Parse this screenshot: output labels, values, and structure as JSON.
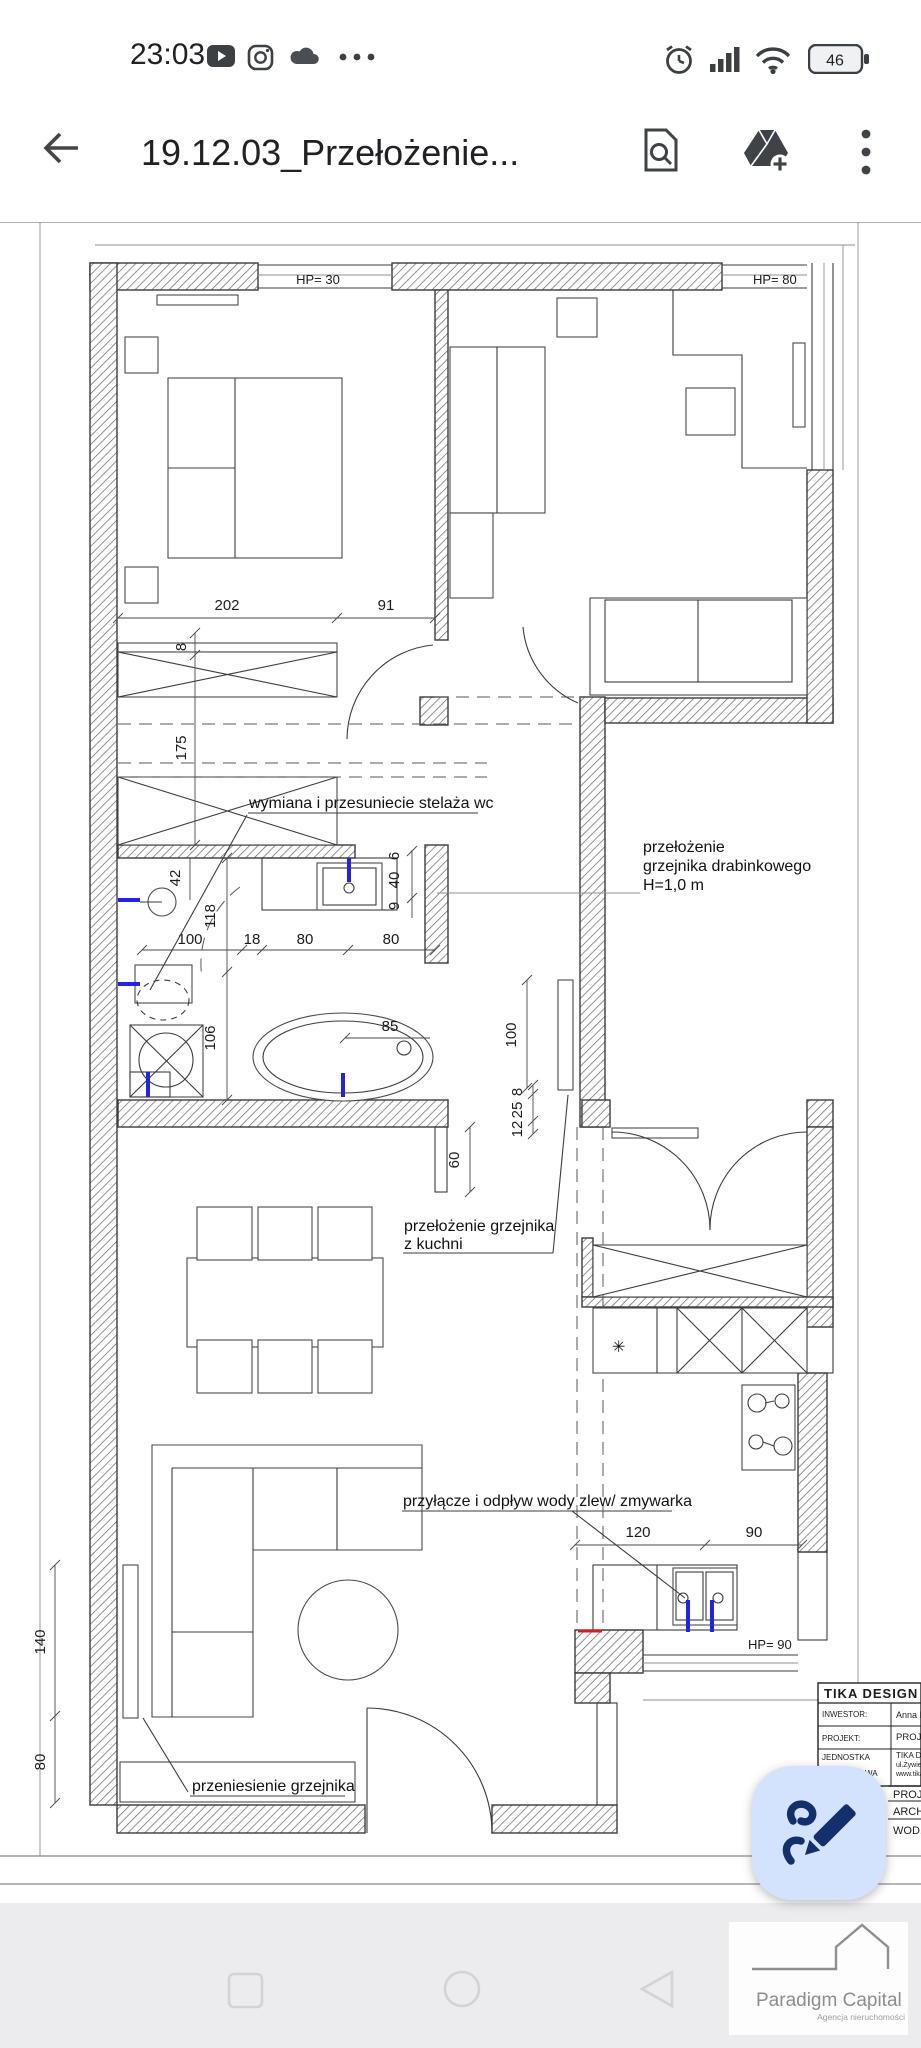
{
  "status": {
    "time": "23:03",
    "battery": "46"
  },
  "appbar": {
    "title": "19.12.03_Przełożenie..."
  },
  "plan": {
    "hp30": "HP= 30",
    "hp80": "HP= 80",
    "hp90": "HP= 90",
    "ann_wc": "wymiana i przesuniecie stelaża wc",
    "ann_tow1": "przełożenie",
    "ann_tow2": "grzejnika drabinkowego",
    "ann_tow3": "H=1,0 m",
    "ann_kit1": "przełożenie grzejnika",
    "ann_kit2": "z kuchni",
    "ann_sink": "przyłącze i odpływ wody zlew/ zmywarka",
    "ann_liv": "przeniesienie grzejnika",
    "sym_star": "✳",
    "d202": "202",
    "d91": "91",
    "d8": "8",
    "d175": "175",
    "d42": "42",
    "d118": "118",
    "d106": "106",
    "d100": "100",
    "d18": "18",
    "d80a": "80",
    "d80b": "80",
    "d6": "6",
    "d40": "40",
    "d9": "9",
    "d85": "85",
    "d100b": "100",
    "d60": "60",
    "d12": "12",
    "d25": "25",
    "d8b": "8",
    "d120": "120",
    "d90": "90",
    "d140": "140",
    "d80c": "80"
  },
  "titleblock": {
    "company": "TIKA DESIGN",
    "inw_l": "INWESTOR:",
    "inw_v": "Anna Ka",
    "proj_l": "PROJEKT:",
    "proj_v": "PROJEK",
    "jed_l1": "JEDNOSTKA",
    "jed_l2": "PROJEKTOWA",
    "jed_v1": "TIKA DE",
    "jed_v2": "ul.Żywiec",
    "jed_v3": "www.tika",
    "r1": "PROJE",
    "r2": "ARCH",
    "r3": "WOD,"
  },
  "watermark": {
    "title": "Paradigm Capital",
    "sub": "Agencja nieruchomości"
  }
}
